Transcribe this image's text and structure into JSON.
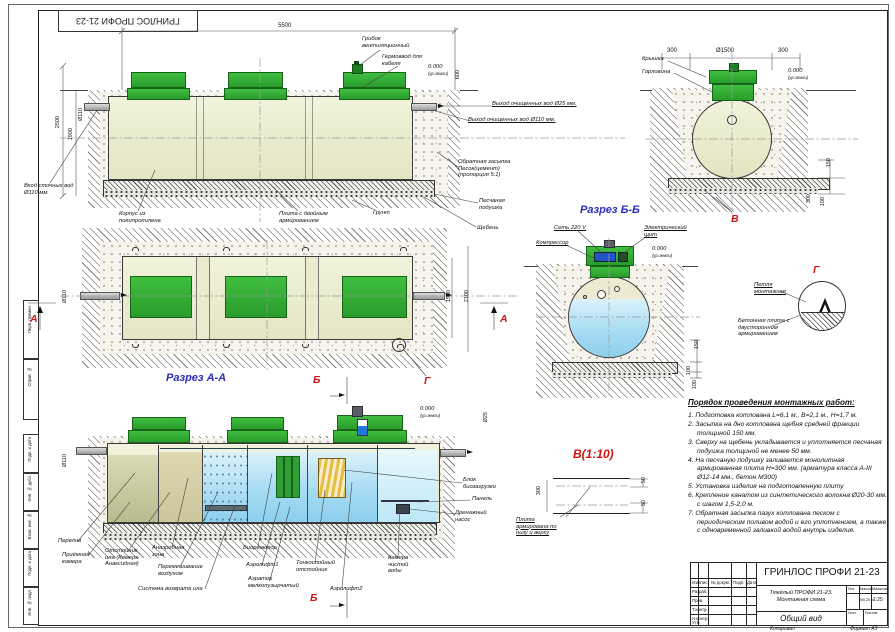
{
  "frame": {
    "corner_stamp": "ГРИНЛОС ПРОФИ 21-23",
    "margin": [
      "Перв. примен.",
      "Справ. №",
      "Подп. и дата",
      "Инв. № дубл.",
      "Взам. инв. №",
      "Подп. и дата",
      "Инв. № подл."
    ]
  },
  "marks": {
    "a": "А",
    "b": "Б",
    "g": "Г",
    "v": "В"
  },
  "captions": {
    "aa": "Разрез А-А",
    "bb": "Разрез Б-Б",
    "v10": "В(1:10)"
  },
  "side": {
    "dim_5500": "5500",
    "dim_2500": "2500",
    "dim_1900": "1900",
    "dim_600": "600",
    "d110": "Ø110",
    "vent": "Грибок вентиляционный",
    "gland": "Гермоввод для кабеля",
    "inlet": "Вход сточных вод Ø110 мм.",
    "body": "Корпус из полипропилена",
    "slab": "Плита с двойным армированием",
    "soil": "Грунт",
    "out25": "Выход очищенных вод Ø25 мм.",
    "out110": "Выход очищенных вод Ø110 мм.",
    "backfill": "Обратная засыпка Песок(цемент) (пропорция 5:1)",
    "sand": "Песчаная подушка",
    "gravel": "Щебень",
    "level": "0.000",
    "level_sub": "(ур.земли)"
  },
  "plan": {
    "d1500": "1500",
    "d2100": "2100",
    "d110": "Ø110"
  },
  "cross": {
    "cap": "Крышка",
    "neck": "Горловина",
    "d300l": "300",
    "d1500": "Ø1500",
    "d300r": "300",
    "d150": "150",
    "d300": "300",
    "d100": "100",
    "level": "0.000",
    "level_sub": "(ур.земли)"
  },
  "razrez_b": {
    "net": "Сеть 220 V",
    "compressor": "Компрессор",
    "panel": "Электрический щит",
    "d150": "150",
    "d100a": "100",
    "d100b": "100",
    "level": "0.000",
    "level_sub": "(ур.земли)"
  },
  "detail_g": {
    "loop": "Петля монтажная",
    "plate": "Бетонная плита с двусторонним армированием"
  },
  "detail_v": {
    "d300": "300",
    "d50a": "50",
    "d50b": "50",
    "lbl": "Плита армирована по низу и верху"
  },
  "section": {
    "overflow": "Перелив",
    "d110": "Ø110",
    "d25": "Ø25",
    "level": "0.000",
    "level_sub": "(ур.земли)",
    "chambers": [
      "Приёмная камера",
      "Отстойник ила (Камера Анаксидная)",
      "Анаэробная зона",
      "Перемешивание воздухом",
      "Система возврата ила",
      "Биореактор",
      "Аэролифт1",
      "Аэратор мелкопузырчатый",
      "Тонкослойный отстойник",
      "Аэролифт2",
      "Камера чистой воды"
    ],
    "block": "Блок биозагрузки",
    "panel": "Панель",
    "pump": "Дренажный насос"
  },
  "worklist": {
    "title": "Порядок проведения монтажных работ:",
    "items": [
      "1.  Подготовка котлована L=6,1 м., B=2,1 м., H=1,7 м.",
      "2.  Засыпка на дно котлована щебня средней фракции толщиной 150 мм.",
      "3.  Сверху на щебень укладывается и уплотняется песчаная подушка толщиной не менее 50 мм.",
      "4.  На песчаную подушку заливается монолитная армированная плита H=300 мм. (арматура класса А-III Ø12-14 мм., бетон М300)",
      "5.  Установка изделия на подготовленную плиту",
      "6.  Крепление канатом из синтетического волокна Ø20-30 мм. с шагом 1,5-2,0 м.",
      "7.  Обратная засыпка пазух котлована песком с периодическим поливом водой и его уплотнением, а также с одновременной заливкой водой внутрь изделия."
    ]
  },
  "stamp": {
    "brand": "ГРИНЛОС ПРОФИ 21-23",
    "desc1": "Тяжёлый ПРОФИ 21-23.",
    "desc2": "Монтажная схема",
    "view": "Общий вид",
    "mass": "490,25 кг",
    "scale": "1:25",
    "head": [
      "Изм.",
      "Лист",
      "№ докум.",
      "Подп.",
      "Дата"
    ],
    "rows": [
      "Разраб.",
      "Пров.",
      "Т.контр.",
      "Н.контр.",
      "Утв."
    ],
    "lit": "Лит.",
    "mass_h": "Масса",
    "scale_h": "Масштаб",
    "sheet": "Лист",
    "sheets": "Листов",
    "copied": "Копировал",
    "format": "Формат А3"
  }
}
